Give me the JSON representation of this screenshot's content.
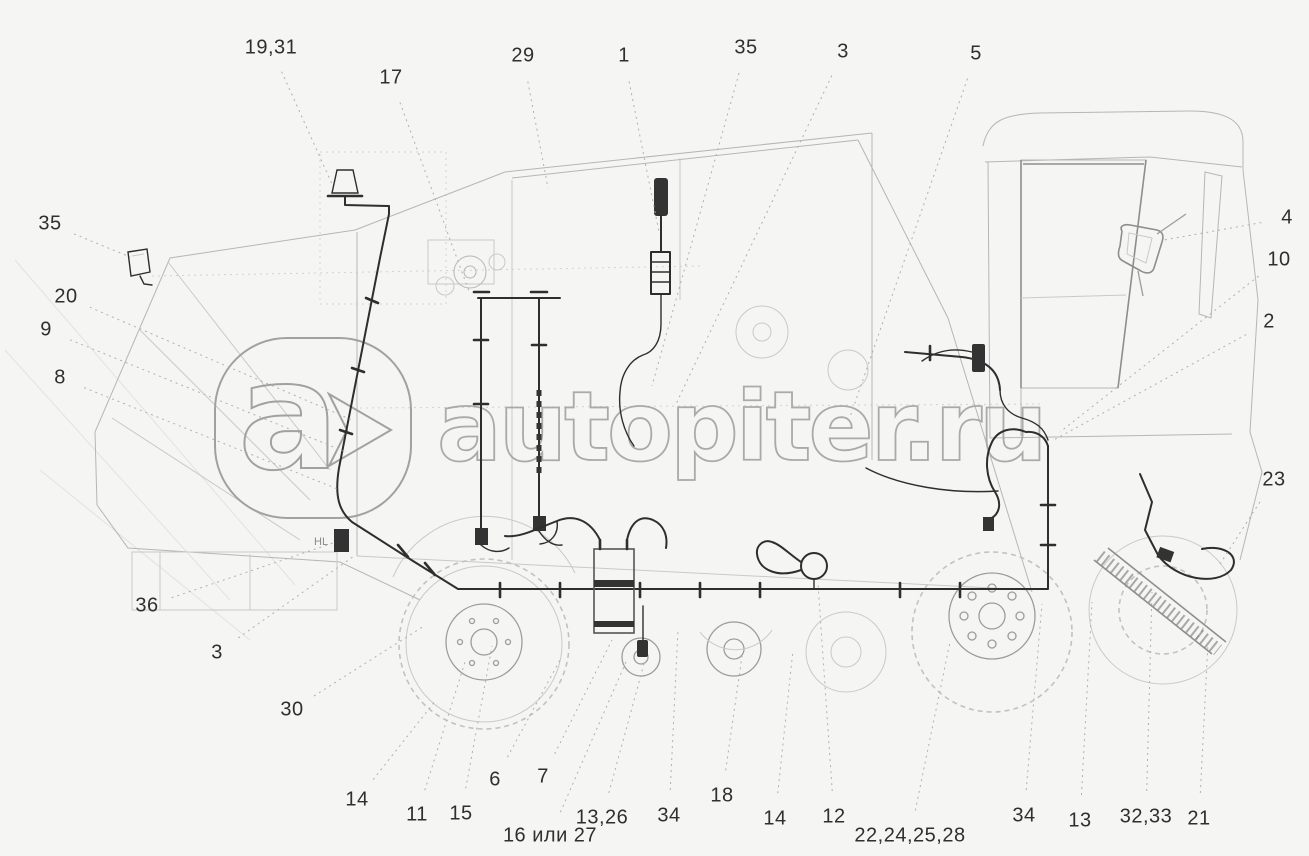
{
  "page": {
    "width": 1309,
    "height": 856,
    "background": "#f5f5f3"
  },
  "colors": {
    "label_text": "#2f2f2f",
    "leader_line": "#b0b0b0",
    "machine_outline": "#b6b6b6",
    "wiring_harness": "#2e2e2e",
    "watermark": "#9d9d9d"
  },
  "drawing": {
    "description": "combine-harvester side view with electrical wiring harness",
    "component_label": "HL"
  },
  "watermark": {
    "logo_letter": "a",
    "logo_icon": "arrow-right-chevron",
    "text": "autopiter.ru"
  },
  "callouts": [
    {
      "label": "19,31",
      "x": 271,
      "y": 48,
      "tx": 332,
      "ty": 184
    },
    {
      "label": "17",
      "x": 391,
      "y": 78,
      "tx": 470,
      "ty": 294
    },
    {
      "label": "29",
      "x": 523,
      "y": 56,
      "tx": 548,
      "ty": 188
    },
    {
      "label": "1",
      "x": 624,
      "y": 56,
      "tx": 659,
      "ty": 232
    },
    {
      "label": "35",
      "x": 746,
      "y": 48,
      "tx": 652,
      "ty": 386
    },
    {
      "label": "3",
      "x": 843,
      "y": 52,
      "tx": 676,
      "ty": 404
    },
    {
      "label": "5",
      "x": 976,
      "y": 54,
      "tx": 850,
      "ty": 417
    },
    {
      "label": "4",
      "x": 1287,
      "y": 218,
      "tx": 1164,
      "ty": 240
    },
    {
      "label": "10",
      "x": 1279,
      "y": 260,
      "tx": 1060,
      "ty": 432
    },
    {
      "label": "2",
      "x": 1269,
      "y": 322,
      "tx": 1052,
      "ty": 441
    },
    {
      "label": "23",
      "x": 1274,
      "y": 480,
      "tx": 1220,
      "ty": 564
    },
    {
      "label": "35",
      "x": 50,
      "y": 224,
      "tx": 130,
      "ty": 257
    },
    {
      "label": "20",
      "x": 66,
      "y": 297,
      "tx": 352,
      "ty": 420
    },
    {
      "label": "9",
      "x": 46,
      "y": 330,
      "tx": 346,
      "ty": 452
    },
    {
      "label": "8",
      "x": 60,
      "y": 378,
      "tx": 340,
      "ty": 490
    },
    {
      "label": "36",
      "x": 147,
      "y": 606,
      "tx": 336,
      "ty": 542
    },
    {
      "label": "3",
      "x": 217,
      "y": 653,
      "tx": 354,
      "ty": 556
    },
    {
      "label": "30",
      "x": 292,
      "y": 710,
      "tx": 424,
      "ty": 626
    },
    {
      "label": "14",
      "x": 357,
      "y": 800,
      "tx": 436,
      "ty": 700
    },
    {
      "label": "11",
      "x": 417,
      "y": 815,
      "tx": 465,
      "ty": 662
    },
    {
      "label": "15",
      "x": 461,
      "y": 814,
      "tx": 492,
      "ty": 646
    },
    {
      "label": "6",
      "x": 495,
      "y": 780,
      "tx": 560,
      "ty": 660
    },
    {
      "label": "7",
      "x": 543,
      "y": 777,
      "tx": 612,
      "ty": 640
    },
    {
      "label": "16 или 27",
      "x": 550,
      "y": 836,
      "tx": 626,
      "ty": 662
    },
    {
      "label": "13,26",
      "x": 602,
      "y": 818,
      "tx": 645,
      "ty": 660
    },
    {
      "label": "34",
      "x": 669,
      "y": 816,
      "tx": 678,
      "ty": 630
    },
    {
      "label": "18",
      "x": 722,
      "y": 796,
      "tx": 742,
      "ty": 656
    },
    {
      "label": "14",
      "x": 775,
      "y": 819,
      "tx": 793,
      "ty": 650
    },
    {
      "label": "12",
      "x": 834,
      "y": 817,
      "tx": 818,
      "ty": 584
    },
    {
      "label": "22,24,25,28",
      "x": 910,
      "y": 836,
      "tx": 950,
      "ty": 642
    },
    {
      "label": "34",
      "x": 1024,
      "y": 816,
      "tx": 1042,
      "ty": 604
    },
    {
      "label": "13",
      "x": 1080,
      "y": 821,
      "tx": 1092,
      "ty": 602
    },
    {
      "label": "32,33",
      "x": 1146,
      "y": 817,
      "tx": 1152,
      "ty": 592
    },
    {
      "label": "21",
      "x": 1199,
      "y": 819,
      "tx": 1208,
      "ty": 642
    }
  ]
}
